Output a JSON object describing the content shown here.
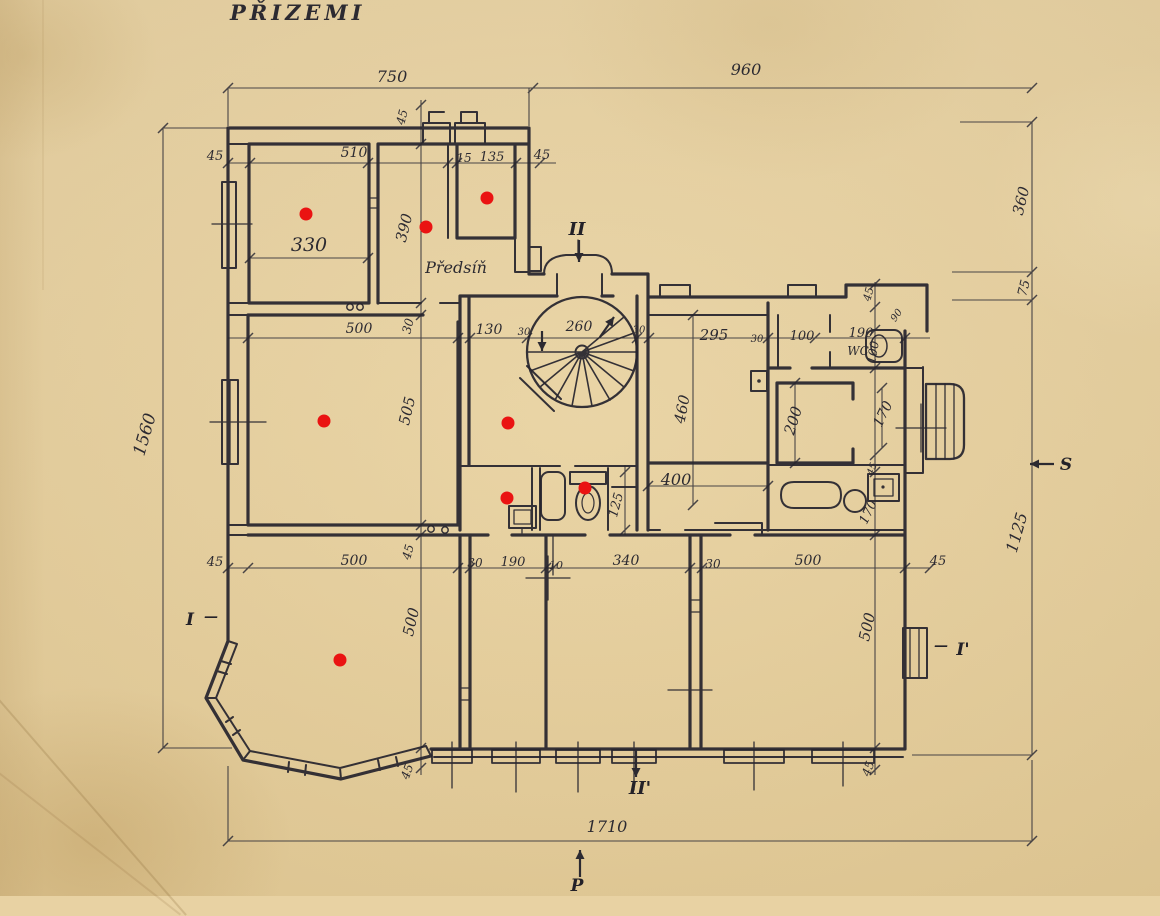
{
  "title": "PŘIZEMI",
  "colors": {
    "paper": "#e8d2a3",
    "ink": "#2c2a31",
    "marker_red": "#ea1312"
  },
  "plan": {
    "labels": [
      {
        "t": "750",
        "x": 392,
        "y": 82,
        "s": 16
      },
      {
        "t": "960",
        "x": 746,
        "y": 75,
        "s": 16
      },
      {
        "t": "1560",
        "x": 150,
        "y": 436,
        "r": -74,
        "s": 17
      },
      {
        "t": "360",
        "x": 1026,
        "y": 202,
        "r": -76,
        "s": 15
      },
      {
        "t": "75",
        "x": 1028,
        "y": 289,
        "r": -76,
        "s": 13
      },
      {
        "t": "1125",
        "x": 1022,
        "y": 534,
        "r": -74,
        "s": 16
      },
      {
        "t": "1710",
        "x": 607,
        "y": 832,
        "s": 16
      },
      {
        "t": "45",
        "x": 215,
        "y": 160,
        "s": 13
      },
      {
        "t": "510",
        "x": 354,
        "y": 157,
        "s": 14
      },
      {
        "t": "15",
        "x": 464,
        "y": 162,
        "s": 12
      },
      {
        "t": "135",
        "x": 492,
        "y": 161,
        "s": 13
      },
      {
        "t": "45",
        "x": 542,
        "y": 159,
        "s": 13
      },
      {
        "t": "45",
        "x": 406,
        "y": 118,
        "r": -76,
        "s": 12
      },
      {
        "t": "330",
        "x": 309,
        "y": 251,
        "s": 19
      },
      {
        "t": "390",
        "x": 409,
        "y": 229,
        "r": -76,
        "s": 15
      },
      {
        "t": "Předsíň",
        "x": 456,
        "y": 273,
        "s": 16
      },
      {
        "t": "500",
        "x": 359,
        "y": 333,
        "s": 14
      },
      {
        "t": "30",
        "x": 412,
        "y": 327,
        "r": -76,
        "s": 12
      },
      {
        "t": "130",
        "x": 489,
        "y": 334,
        "s": 14
      },
      {
        "t": "30",
        "x": 524,
        "y": 335,
        "s": 10
      },
      {
        "t": "260",
        "x": 579,
        "y": 331,
        "s": 14
      },
      {
        "t": "30",
        "x": 639,
        "y": 333,
        "s": 10
      },
      {
        "t": "295",
        "x": 714,
        "y": 340,
        "s": 15
      },
      {
        "t": "30",
        "x": 757,
        "y": 342,
        "s": 10
      },
      {
        "t": "100",
        "x": 802,
        "y": 340,
        "s": 13
      },
      {
        "t": "190",
        "x": 861,
        "y": 337,
        "s": 13
      },
      {
        "t": "WC",
        "x": 858,
        "y": 355,
        "s": 12
      },
      {
        "t": "100",
        "x": 877,
        "y": 353,
        "r": -80,
        "s": 12
      },
      {
        "t": "45",
        "x": 872,
        "y": 295,
        "r": -76,
        "s": 11
      },
      {
        "t": "90",
        "x": 899,
        "y": 317,
        "r": -55,
        "s": 10
      },
      {
        "t": "505",
        "x": 412,
        "y": 412,
        "r": -77,
        "s": 15
      },
      {
        "t": "460",
        "x": 687,
        "y": 410,
        "r": -79,
        "s": 15
      },
      {
        "t": "200",
        "x": 798,
        "y": 422,
        "r": -73,
        "s": 15
      },
      {
        "t": "170",
        "x": 887,
        "y": 416,
        "r": -64,
        "s": 14
      },
      {
        "t": "400",
        "x": 676,
        "y": 485,
        "s": 16
      },
      {
        "t": "125",
        "x": 620,
        "y": 506,
        "r": -75,
        "s": 13
      },
      {
        "t": "45",
        "x": 875,
        "y": 470,
        "r": -70,
        "s": 10
      },
      {
        "t": "170",
        "x": 872,
        "y": 514,
        "r": -64,
        "s": 13
      },
      {
        "t": "45",
        "x": 215,
        "y": 566,
        "s": 13
      },
      {
        "t": "500",
        "x": 354,
        "y": 565,
        "s": 14
      },
      {
        "t": "45",
        "x": 412,
        "y": 553,
        "r": -75,
        "s": 12
      },
      {
        "t": "30",
        "x": 475,
        "y": 567,
        "s": 12
      },
      {
        "t": "190",
        "x": 513,
        "y": 566,
        "s": 13
      },
      {
        "t": "10",
        "x": 556,
        "y": 569,
        "s": 11
      },
      {
        "t": "340",
        "x": 626,
        "y": 565,
        "s": 14
      },
      {
        "t": "30",
        "x": 713,
        "y": 568,
        "s": 12
      },
      {
        "t": "500",
        "x": 808,
        "y": 565,
        "s": 14
      },
      {
        "t": "45",
        "x": 938,
        "y": 565,
        "s": 13
      },
      {
        "t": "500",
        "x": 416,
        "y": 623,
        "r": -77,
        "s": 15
      },
      {
        "t": "500",
        "x": 872,
        "y": 628,
        "r": -77,
        "s": 15
      },
      {
        "t": "45",
        "x": 411,
        "y": 773,
        "r": -70,
        "s": 12
      },
      {
        "t": "45",
        "x": 872,
        "y": 770,
        "r": -70,
        "s": 12
      }
    ],
    "markers": [
      {
        "t": "II",
        "x": 577,
        "y": 235,
        "s": 18
      },
      {
        "t": "II'",
        "x": 640,
        "y": 794,
        "s": 18
      },
      {
        "t": "I",
        "x": 190,
        "y": 625,
        "s": 17
      },
      {
        "t": "—",
        "x": 211,
        "y": 621,
        "s": 14
      },
      {
        "t": "—",
        "x": 941,
        "y": 650,
        "s": 14
      },
      {
        "t": "I'",
        "x": 963,
        "y": 655,
        "s": 17
      },
      {
        "t": "P",
        "x": 577,
        "y": 891,
        "s": 17
      },
      {
        "t": "S",
        "x": 1066,
        "y": 470,
        "s": 17
      }
    ],
    "arrows": [
      {
        "x1": 579,
        "y1": 240,
        "x2": 579,
        "y2": 262
      },
      {
        "x1": 636,
        "y1": 750,
        "x2": 636,
        "y2": 777
      },
      {
        "x1": 580,
        "y1": 877,
        "x2": 580,
        "y2": 850
      },
      {
        "x1": 1054,
        "y1": 464,
        "x2": 1030,
        "y2": 464
      },
      {
        "x1": 600,
        "y1": 337,
        "x2": 614,
        "y2": 317
      },
      {
        "x1": 542,
        "y1": 331,
        "x2": 542,
        "y2": 351
      }
    ],
    "red_dots": [
      {
        "x": 306,
        "y": 214
      },
      {
        "x": 426,
        "y": 227
      },
      {
        "x": 487,
        "y": 198
      },
      {
        "x": 324,
        "y": 421
      },
      {
        "x": 508,
        "y": 423
      },
      {
        "x": 507,
        "y": 498
      },
      {
        "x": 585,
        "y": 488
      },
      {
        "x": 340,
        "y": 660
      }
    ]
  }
}
